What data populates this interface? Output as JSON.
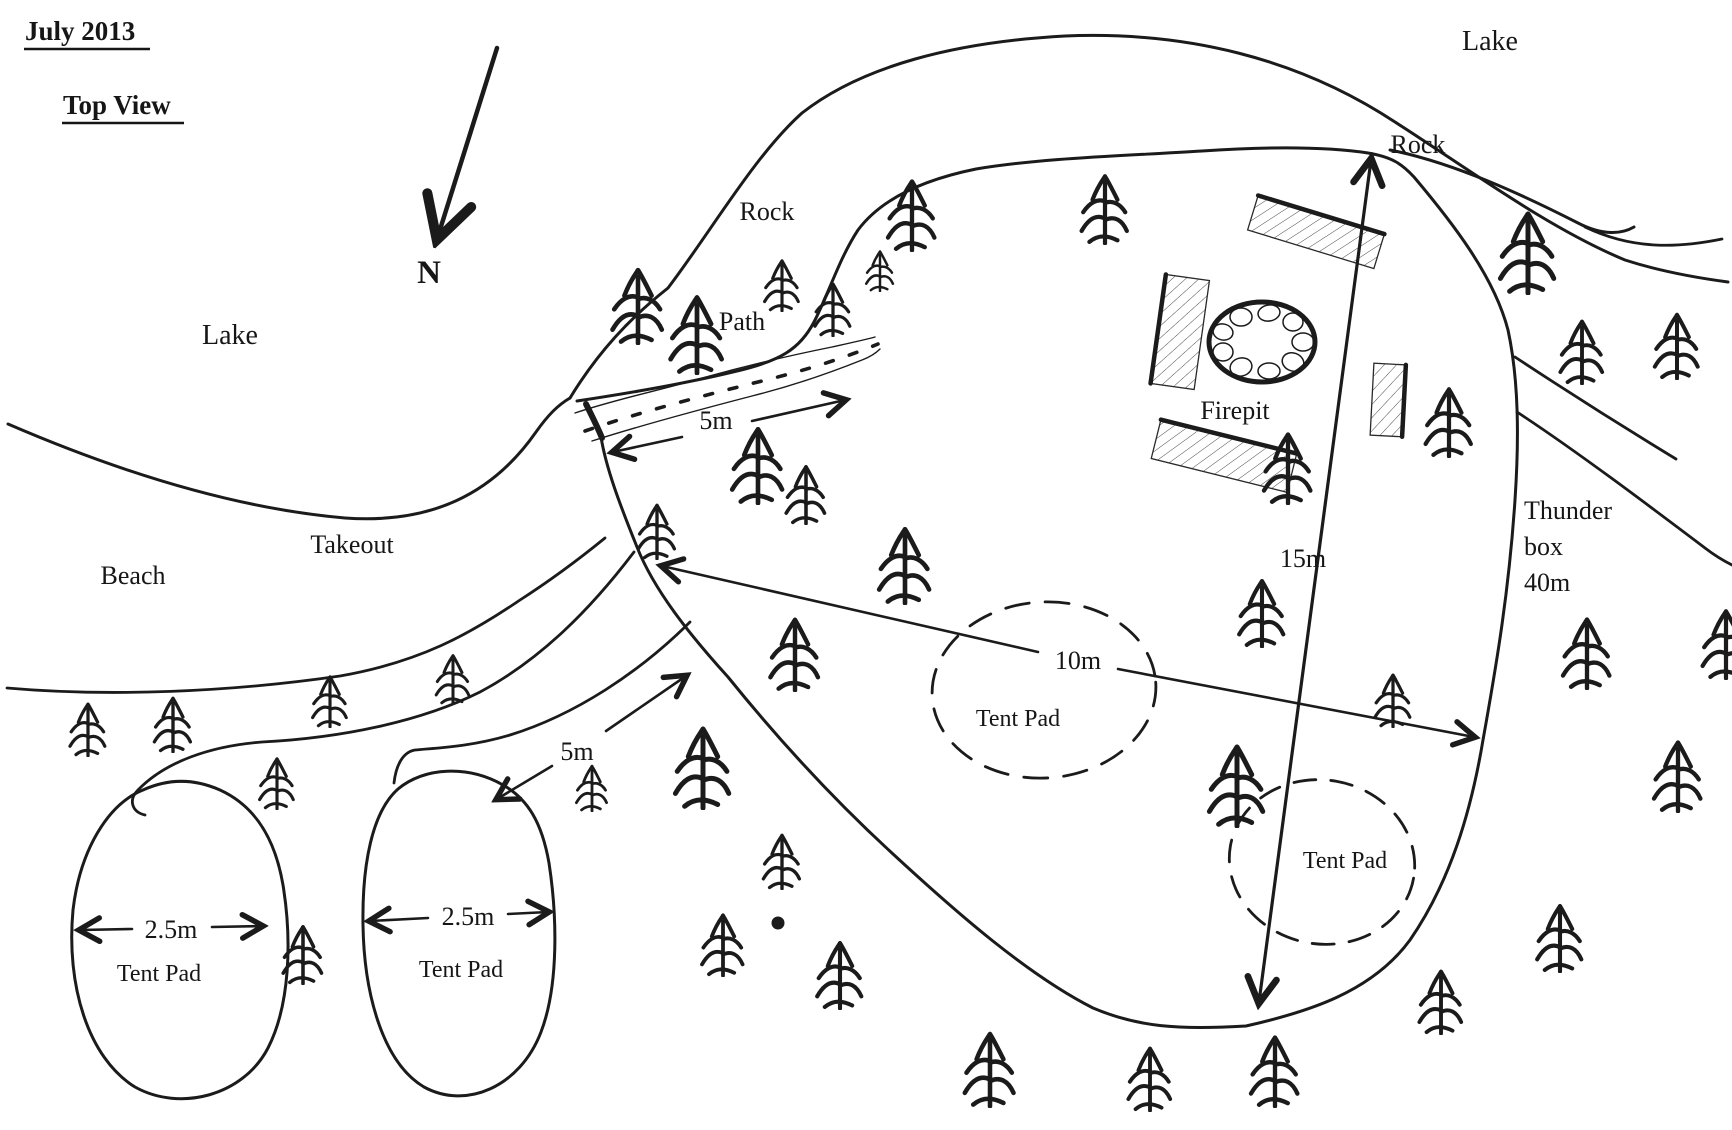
{
  "title": {
    "date": "July 2013",
    "view_label": "Top View"
  },
  "compass": {
    "north_label": "N"
  },
  "water": {
    "lake_west": "Lake",
    "lake_northeast": "Lake",
    "beach": "Beach",
    "takeout": "Takeout"
  },
  "terrain": {
    "rock_inner": "Rock",
    "rock_point": "Rock"
  },
  "access_path": {
    "label": "Path",
    "width": "5m"
  },
  "south_trail": {
    "width": "5m"
  },
  "campsite": {
    "length": "15m",
    "width": "10m",
    "firepit_label": "Firepit",
    "thunder_box": {
      "line1": "Thunder",
      "line2": "box",
      "line3": "40m"
    }
  },
  "tent_pads": [
    {
      "label": "Tent Pad"
    },
    {
      "label": "Tent Pad"
    },
    {
      "label": "Tent Pad",
      "width": "2.5m"
    },
    {
      "label": "Tent Pad",
      "width": "2.5m"
    }
  ],
  "colors": {
    "ink": "#1b1b1b",
    "paper": "#ffffff"
  },
  "trees": [
    {
      "x": 638,
      "y": 345,
      "h": 85
    },
    {
      "x": 697,
      "y": 375,
      "h": 88
    },
    {
      "x": 782,
      "y": 312,
      "h": 58
    },
    {
      "x": 833,
      "y": 337,
      "h": 60
    },
    {
      "x": 880,
      "y": 292,
      "h": 46
    },
    {
      "x": 912,
      "y": 252,
      "h": 80
    },
    {
      "x": 1105,
      "y": 245,
      "h": 78
    },
    {
      "x": 758,
      "y": 505,
      "h": 86
    },
    {
      "x": 806,
      "y": 525,
      "h": 66
    },
    {
      "x": 657,
      "y": 560,
      "h": 62
    },
    {
      "x": 795,
      "y": 692,
      "h": 82
    },
    {
      "x": 905,
      "y": 605,
      "h": 86
    },
    {
      "x": 1528,
      "y": 295,
      "h": 92
    },
    {
      "x": 1582,
      "y": 385,
      "h": 72
    },
    {
      "x": 1677,
      "y": 380,
      "h": 74
    },
    {
      "x": 1449,
      "y": 458,
      "h": 78
    },
    {
      "x": 1288,
      "y": 505,
      "h": 80
    },
    {
      "x": 1262,
      "y": 648,
      "h": 76
    },
    {
      "x": 1393,
      "y": 728,
      "h": 60
    },
    {
      "x": 1237,
      "y": 828,
      "h": 92
    },
    {
      "x": 88,
      "y": 757,
      "h": 60
    },
    {
      "x": 173,
      "y": 753,
      "h": 62
    },
    {
      "x": 330,
      "y": 728,
      "h": 58
    },
    {
      "x": 453,
      "y": 705,
      "h": 56
    },
    {
      "x": 277,
      "y": 810,
      "h": 58
    },
    {
      "x": 303,
      "y": 985,
      "h": 66
    },
    {
      "x": 592,
      "y": 812,
      "h": 52
    },
    {
      "x": 703,
      "y": 810,
      "h": 92
    },
    {
      "x": 723,
      "y": 977,
      "h": 70
    },
    {
      "x": 782,
      "y": 890,
      "h": 62
    },
    {
      "x": 840,
      "y": 1010,
      "h": 76
    },
    {
      "x": 990,
      "y": 1108,
      "h": 84
    },
    {
      "x": 1150,
      "y": 1112,
      "h": 72
    },
    {
      "x": 1275,
      "y": 1108,
      "h": 80
    },
    {
      "x": 1441,
      "y": 1035,
      "h": 72
    },
    {
      "x": 1560,
      "y": 973,
      "h": 76
    },
    {
      "x": 1587,
      "y": 690,
      "h": 80
    },
    {
      "x": 1678,
      "y": 813,
      "h": 80
    },
    {
      "x": 1726,
      "y": 680,
      "h": 78
    }
  ]
}
